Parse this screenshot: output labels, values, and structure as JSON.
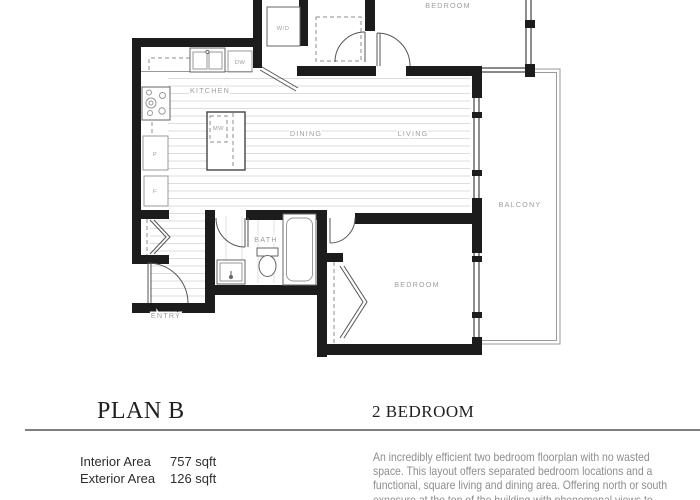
{
  "floorplan": {
    "rooms": {
      "kitchen": "KITCHEN",
      "dining": "DINING",
      "living": "LIVING",
      "bedroom_top": "BEDROOM",
      "bedroom_bottom": "BEDROOM",
      "bath": "BATH",
      "entry": "ENTRY",
      "balcony": "BALCONY"
    },
    "fixtures": {
      "washer_dryer": "W/D",
      "dishwasher": "DW",
      "microwave": "MW",
      "pantry": "P",
      "fridge": "F"
    }
  },
  "header": {
    "plan_name": "PLAN B",
    "plan_type": "2 BEDROOM"
  },
  "areas": {
    "interior_label": "Interior Area",
    "interior_value": "757 sqft",
    "exterior_label": "Exterior Area",
    "exterior_value": "126 sqft"
  },
  "description": {
    "lines": [
      "An incredibly efficient two bedroom floorplan with no wasted",
      "space. This layout offers separated bedroom locations and a",
      "functional, square living and dining area. Offering north or south",
      "exposure at the top of the building with phenomenal views to"
    ]
  },
  "colors": {
    "wall": "#1c1c1c",
    "floor_hatch": "#dcdcdc",
    "label_gray": "#9e9e9e",
    "title_text": "#1f1f1f",
    "body_text": "#8e8e8e",
    "divider": "#7e7e7e"
  }
}
